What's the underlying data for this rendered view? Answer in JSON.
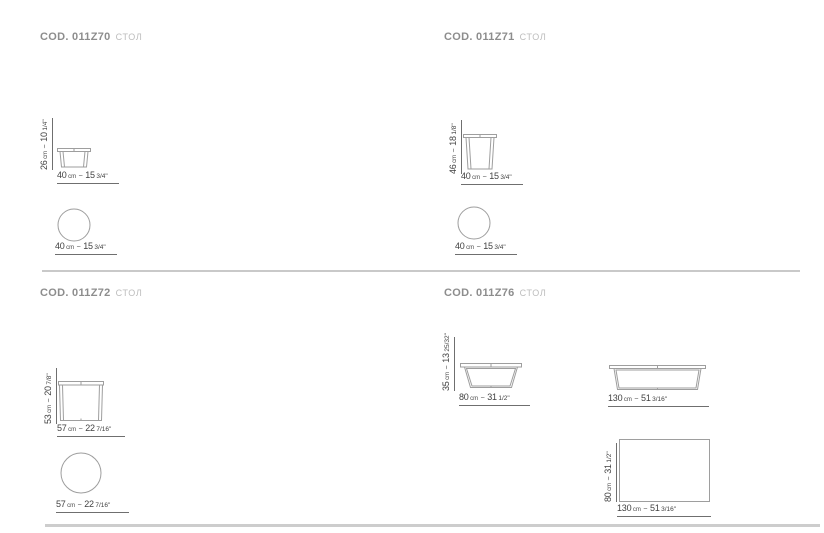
{
  "labels": {
    "unit_cm": "cm",
    "sep": "~"
  },
  "sections": [
    {
      "code": "COD. 011Z70",
      "category": "СТОЛ",
      "dims": {
        "height": {
          "cm": "26",
          "in": "10",
          "frac": "1/4\""
        },
        "width": {
          "cm": "40",
          "in": "15",
          "frac": "3/4\""
        },
        "diameter": {
          "cm": "40",
          "in": "15",
          "frac": "3/4\""
        }
      }
    },
    {
      "code": "COD. 011Z71",
      "category": "СТОЛ",
      "dims": {
        "height": {
          "cm": "46",
          "in": "18",
          "frac": "1/8\""
        },
        "width": {
          "cm": "40",
          "in": "15",
          "frac": "3/4\""
        },
        "diameter": {
          "cm": "40",
          "in": "15",
          "frac": "3/4\""
        }
      }
    },
    {
      "code": "COD. 011Z72",
      "category": "СТОЛ",
      "dims": {
        "height": {
          "cm": "53",
          "in": "20",
          "frac": "7/8\""
        },
        "width": {
          "cm": "57",
          "in": "22",
          "frac": "7/16\""
        },
        "diameter": {
          "cm": "57",
          "in": "22",
          "frac": "7/16\""
        }
      }
    },
    {
      "code": "COD. 011Z76",
      "category": "СТОЛ",
      "dims": {
        "side_height": {
          "cm": "35",
          "in": "13",
          "frac": "25/32\""
        },
        "side_width": {
          "cm": "80",
          "in": "31",
          "frac": "1/2\""
        },
        "front_width": {
          "cm": "130",
          "in": "51",
          "frac": "3/16\""
        },
        "plan_depth": {
          "cm": "80",
          "in": "31",
          "frac": "1/2\""
        },
        "plan_width": {
          "cm": "130",
          "in": "51",
          "frac": "3/16\""
        }
      }
    }
  ]
}
